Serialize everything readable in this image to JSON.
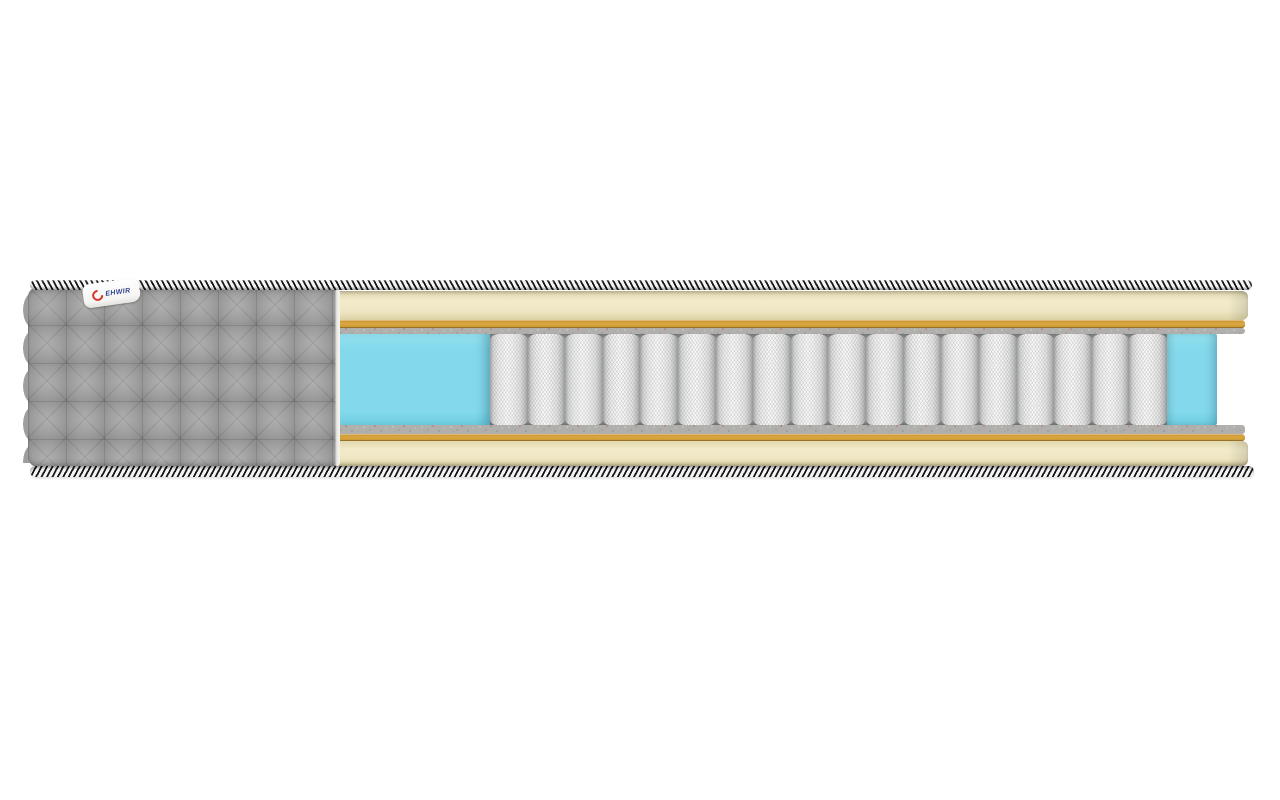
{
  "scene": {
    "kind": "product-photo",
    "subject": "mattress cross-section cutaway",
    "brand_tag": {
      "text": "EHWIR",
      "logo_icon": "red-ring"
    },
    "springs": {
      "count": 18
    },
    "parts": {
      "cover": "quilted-gray-fabric-cover",
      "top_edge": "braided-piping",
      "bottom_edge": "braided-piping",
      "top_layer": "cream-foam",
      "thin_layers": "gold-latex-and-gray-felt",
      "side_blocks": "blue-foam-encasement",
      "core": "white-pocket-springs"
    },
    "colors": {
      "bg": "#ffffff",
      "cover_gray": "#9e9e9e",
      "cover_gray_light": "#b0b0b0",
      "cover_gray_dark": "#8a8a8a",
      "rope_dark": "#181818",
      "rope_light": "#f4f4f4",
      "foam_cream": "#eee6c3",
      "layer_gold": "#dba742",
      "felt_gray": "#b0afac",
      "foam_blue": "#83d9eb",
      "spring_white": "#fafafa",
      "spring_gap": "#97989a",
      "tag_red": "#d7342a",
      "tag_blue": "#31418f"
    }
  }
}
